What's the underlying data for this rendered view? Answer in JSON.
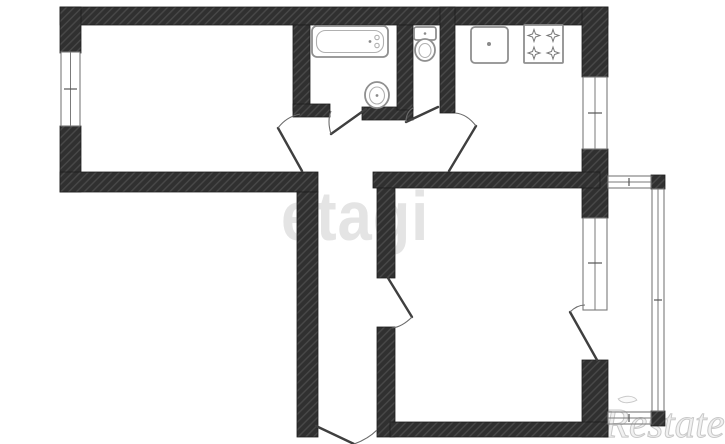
{
  "watermarks": {
    "center": "etagi",
    "corner": "Restate"
  },
  "colors": {
    "background": "#ffffff",
    "wall": "#303030",
    "wall-hatch": "#484848",
    "fixture-line": "#8f8f8f",
    "door-line": "#3f3f3f",
    "thin-line": "#7a7a7a",
    "watermark-center": "#e4e4e4",
    "watermark-corner-stroke": "#c9c9c9",
    "watermark-corner-fill": "#f1f1f1"
  },
  "floorplan": {
    "type": "2-room apartment plan, no dimension labels",
    "fixtures": [
      "bathtub",
      "wash-basin",
      "toilet",
      "kitchen-sink",
      "gas-stove-4-burner"
    ],
    "features": [
      "window-living-room",
      "window-kitchen",
      "window-bedroom",
      "balcony",
      "entrance-door"
    ]
  }
}
